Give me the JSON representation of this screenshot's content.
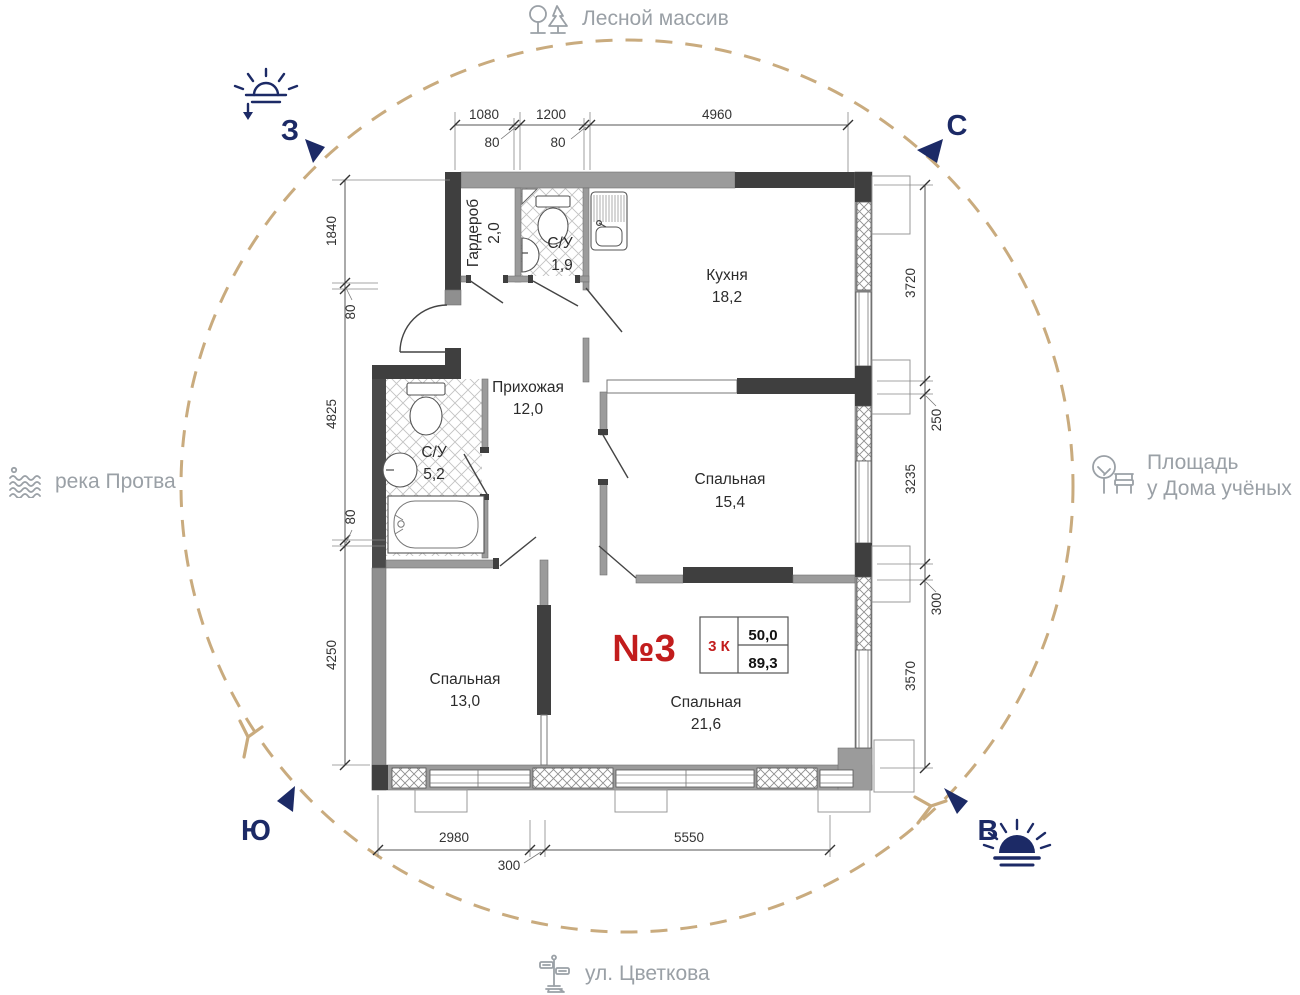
{
  "compass": {
    "north": "С",
    "east": "В",
    "south": "Ю",
    "west": "З"
  },
  "landmarks": {
    "north": "Лесной массив",
    "west": "река Протва",
    "east_line1": "Площадь",
    "east_line2": "у Дома учёных",
    "south": "ул. Цветкова"
  },
  "apartment": {
    "number": "№3",
    "rooms_label": "3 К",
    "area_living": "50,0",
    "area_total": "89,3"
  },
  "rooms": [
    {
      "name": "Гардероб",
      "area": "2,0"
    },
    {
      "name": "С/У",
      "area": "1,9"
    },
    {
      "name": "Кухня",
      "area": "18,2"
    },
    {
      "name": "Прихожая",
      "area": "12,0"
    },
    {
      "name": "С/У",
      "area": "5,2"
    },
    {
      "name": "Спальная",
      "area": "15,4"
    },
    {
      "name": "Спальная",
      "area": "13,0"
    },
    {
      "name": "Спальная",
      "area": "21,6"
    }
  ],
  "dimensions": {
    "top": [
      "1080",
      "80",
      "1200",
      "80",
      "4960"
    ],
    "left": [
      "1840",
      "80",
      "4825",
      "80",
      "4250"
    ],
    "right": [
      "3720",
      "250",
      "3235",
      "300",
      "3570"
    ],
    "bottom": [
      "2980",
      "300",
      "5550"
    ]
  },
  "colors": {
    "accent_navy": "#1c2a66",
    "circle_tan": "#c9ab7e",
    "label_gray": "#9aa0a6",
    "highlight_red": "#c21d1d",
    "wall_gray": "#9b9b9b",
    "wall_dark": "#3f3f3f"
  }
}
